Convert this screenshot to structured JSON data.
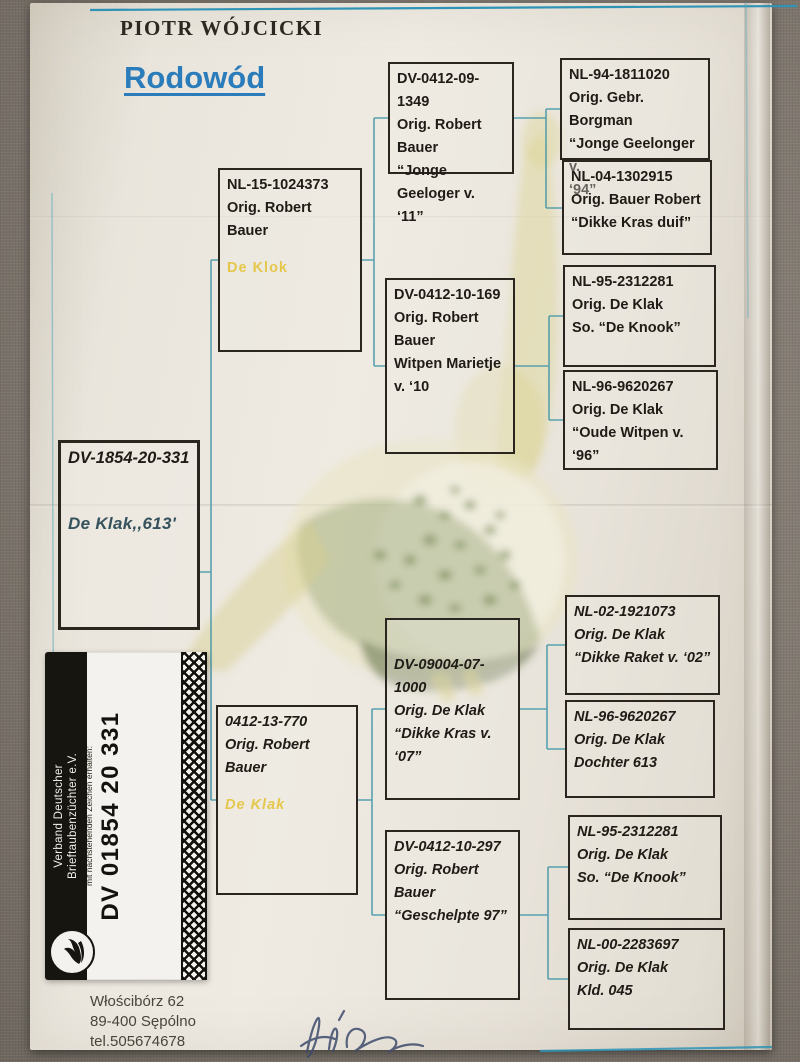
{
  "page": {
    "owner": "PIOTR WÓJCICKI",
    "title": "Rodowód",
    "address_line1": "Włościbórz 62",
    "address_line2": "89-400 Sępólno",
    "address_line3": "tel.505674678"
  },
  "pedigree": {
    "subject": {
      "id": "DV-1854-20-331",
      "name": "De  Klak,,613'"
    },
    "parents": [
      {
        "id": "NL-15-1024373",
        "origin": "Orig. Robert Bauer",
        "name": "De  Klok"
      },
      {
        "id": "0412-13-770",
        "origin": "Orig. Robert Bauer",
        "name": "De  Klak"
      }
    ],
    "grandparents": [
      {
        "id": "DV-0412-09-1349",
        "lines": [
          "Orig. Robert Bauer",
          "“Jonge Geeloger v.",
          "‘11”"
        ]
      },
      {
        "id": "DV-0412-10-169",
        "lines": [
          "Orig. Robert",
          "Bauer",
          "Witpen Marietje",
          "v. ‘10"
        ]
      },
      {
        "id": "DV-09004-07-1000",
        "lines": [
          "Orig. De Klak",
          "“Dikke Kras v. ‘07”"
        ]
      },
      {
        "id": "DV-0412-10-297",
        "lines": [
          "Orig. Robert Bauer",
          "“Geschelpte 97”"
        ]
      }
    ],
    "great_grandparents": [
      {
        "id": "NL-94-1811020",
        "lines": [
          "Orig. Gebr. Borgman",
          "“Jonge Geelonger v.",
          "‘94”"
        ]
      },
      {
        "id": "NL-04-1302915",
        "lines": [
          "Orig. Bauer Robert",
          "“Dikke Kras duif”"
        ]
      },
      {
        "id": "NL-95-2312281",
        "lines": [
          "Orig. De Klak",
          "So. “De Knook”"
        ]
      },
      {
        "id": "NL-96-9620267",
        "lines": [
          "Orig. De Klak",
          "“Oude Witpen v. ‘96”"
        ]
      },
      {
        "id": "NL-02-1921073",
        "lines": [
          "Orig. De Klak",
          "“Dikke Raket v. ‘02”"
        ]
      },
      {
        "id": "NL-96-9620267",
        "lines": [
          "Orig. De Klak",
          "Dochter 613"
        ]
      },
      {
        "id": "NL-95-2312281",
        "lines": [
          "Orig. De Klak",
          "So. “De Knook”"
        ]
      },
      {
        "id": "NL-00-2283697",
        "lines": [
          "Orig. De Klak",
          "Kld. 045"
        ]
      }
    ]
  },
  "sticker": {
    "band_line1": "Verband Deutscher",
    "band_line2": "Brieftaubenzüchter e.V.",
    "title": "Eigentums-Ausweis",
    "note_line1": "Der Besitzer dieser Karte hat den Verbandsring",
    "note_line2": "mit nachstehenden Zeichen erhalten:",
    "ring_number": "DV 01854 20 331"
  },
  "colors": {
    "accent_blue": "#2b7cba",
    "connector_teal": "#4899a9",
    "highlight_yellow": "#e4c23a",
    "subject_name": "#35525d"
  }
}
